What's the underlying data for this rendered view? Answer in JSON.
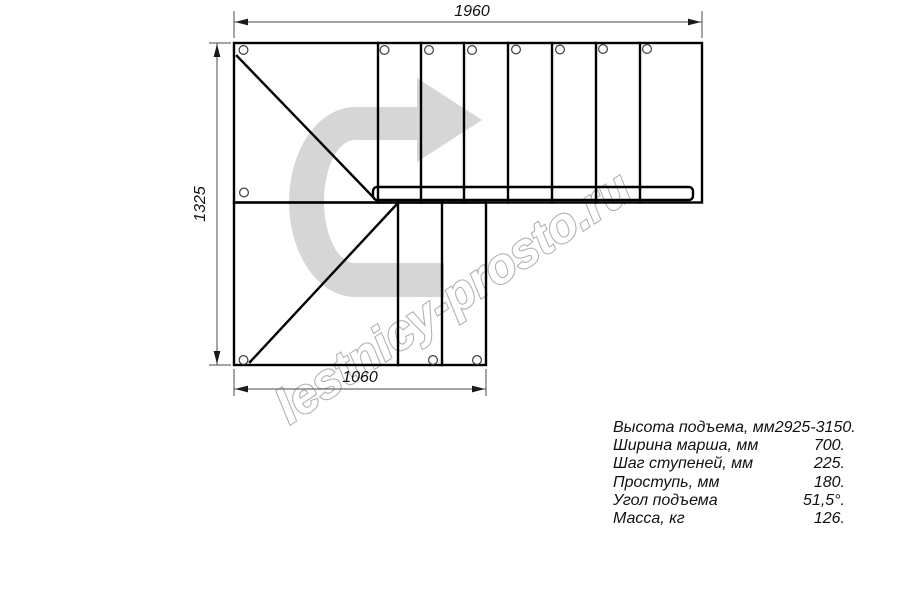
{
  "drawing": {
    "title": "stair-plan-top-view",
    "dimensions": {
      "width_top_mm": "1960",
      "height_left_mm": "1325",
      "width_bottom_mm": "1060"
    },
    "watermark_text": "lestnicy-prosto.ru",
    "colors": {
      "line": "#000000",
      "dimension": "#4a4a4a",
      "watermark_arrow": "#d6d6d6",
      "watermark_outline": "#b2b2b2"
    }
  },
  "specs": {
    "rows": [
      {
        "label": "Высота подъема, мм",
        "value": "2925-3150."
      },
      {
        "label": "Ширина марша, мм",
        "value": "700."
      },
      {
        "label": "Шаг ступеней, мм",
        "value": "225."
      },
      {
        "label": "Проступь, мм",
        "value": "180."
      },
      {
        "label": "Угол подъема",
        "value": "51,5°."
      },
      {
        "label": "Масса, кг",
        "value": "126."
      }
    ]
  }
}
